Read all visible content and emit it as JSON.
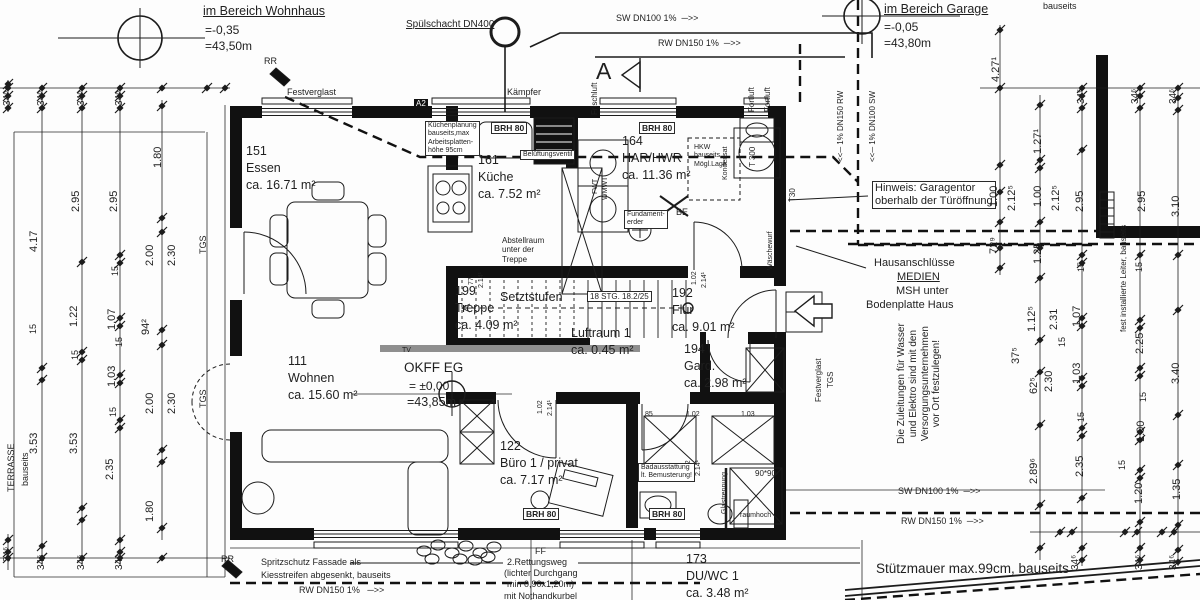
{
  "drawing": {
    "type": "floor-plan",
    "language": "de",
    "level_markers": [
      {
        "area": "im Bereich Wohnhaus",
        "rel": "=-0,35",
        "abs": "=43,50m"
      },
      {
        "area": "im Bereich Garage",
        "rel": "=-0,05",
        "abs": "=43,80m"
      },
      {
        "area": "OKFF EG",
        "rel": "= ±0,00",
        "abs": "=43,85m"
      }
    ],
    "colors": {
      "line": "#1f1f1f",
      "wall": "#111111",
      "bg": "#fdfdfd",
      "tv_band": "#8f8f8f"
    }
  },
  "rooms": [
    {
      "num": "151",
      "name": "Essen",
      "area": "ca. 16.71 m²",
      "x": 246,
      "y": 143
    },
    {
      "num": "161",
      "name": "Küche",
      "area": "ca. 7.52 m²",
      "x": 478,
      "y": 152
    },
    {
      "num": "164",
      "name": "HAR/HWR",
      "area": "ca. 11.36 m²",
      "x": 622,
      "y": 133
    },
    {
      "num": "199",
      "name": "Treppe",
      "area": "ca. 4.09 m²",
      "x": 455,
      "y": 283
    },
    {
      "num": "192",
      "name": "Flur",
      "area": "ca. 9.01 m²",
      "x": 672,
      "y": 285
    },
    {
      "num": "194",
      "name": "Gard.",
      "area": "ca. 2.98 m²",
      "x": 684,
      "y": 341
    },
    {
      "num": "111",
      "name": "Wohnen",
      "area": "ca. 15.60 m²",
      "x": 288,
      "y": 353
    },
    {
      "num": "122",
      "name": "Büro 1 / privat",
      "area": "ca. 7.17 m²",
      "x": 500,
      "y": 438
    },
    {
      "num": "173",
      "name": "DU/WC 1",
      "area": "ca. 3.48 m²",
      "x": 686,
      "y": 551
    }
  ],
  "texts": [
    {
      "t": "im Bereich Wohnhaus",
      "x": 203,
      "y": 4,
      "fs": 12.5,
      "u": 1
    },
    {
      "t": "=-0,35",
      "x": 205,
      "y": 23,
      "fs": 12
    },
    {
      "t": "=43,50m",
      "x": 205,
      "y": 39,
      "fs": 12
    },
    {
      "t": "Spülschacht DN400",
      "x": 406,
      "y": 19,
      "fs": 10,
      "u": 1
    },
    {
      "t": "SW DN100 1%  ─>>",
      "x": 616,
      "y": 13,
      "fs": 9
    },
    {
      "t": "RW DN150 1%  ─>>",
      "x": 658,
      "y": 38,
      "fs": 9
    },
    {
      "t": "im Bereich Garage",
      "x": 884,
      "y": 2,
      "fs": 12.5,
      "u": 1
    },
    {
      "t": "=-0,05",
      "x": 884,
      "y": 20,
      "fs": 12
    },
    {
      "t": "=43,80m",
      "x": 884,
      "y": 36,
      "fs": 12
    },
    {
      "t": "bauseits",
      "x": 1043,
      "y": 1,
      "fs": 9
    },
    {
      "t": "A",
      "x": 596,
      "y": 58,
      "fs": 23
    },
    {
      "t": "Frischluft",
      "x": 590,
      "y": 115,
      "rot": 1,
      "fs": 8
    },
    {
      "t": "Fortluft",
      "x": 747,
      "y": 112,
      "rot": 1,
      "fs": 8
    },
    {
      "t": "Fortluft",
      "x": 763,
      "y": 112,
      "rot": 1,
      "fs": 8
    },
    {
      "t": "<<─ 1% DN150 RW",
      "x": 836,
      "y": 162,
      "rot": 1,
      "fs": 8
    },
    {
      "t": "<<─ 1% DN100 SW",
      "x": 868,
      "y": 162,
      "rot": 1,
      "fs": 8
    },
    {
      "t": "RR",
      "x": 264,
      "y": 56,
      "fs": 9
    },
    {
      "t": "Festverglast",
      "x": 287,
      "y": 87,
      "fs": 9
    },
    {
      "t": "Kämpfer",
      "x": 507,
      "y": 87,
      "fs": 9
    },
    {
      "t": "A2",
      "x": 414,
      "y": 99,
      "fs": 8,
      "inv": 1
    },
    {
      "t": "Küchenplanung\nbauseits,max\nArbeitsplatten-\nhöhe 95cm",
      "x": 425,
      "y": 121,
      "fs": 7,
      "box": 1
    },
    {
      "t": "BRH 80",
      "x": 491,
      "y": 122,
      "fs": 8.5,
      "b": 1,
      "box": 1
    },
    {
      "t": "BRH 80",
      "x": 639,
      "y": 122,
      "fs": 8.5,
      "b": 1,
      "box": 1
    },
    {
      "t": "Belüftungsventil",
      "x": 520,
      "y": 150,
      "fs": 7,
      "box": 1
    },
    {
      "t": "HKW\nbauseits\nMögl.Lage",
      "x": 694,
      "y": 144,
      "fs": 7
    },
    {
      "t": "Kondensat",
      "x": 722,
      "y": 180,
      "rot": 1,
      "fs": 7
    },
    {
      "t": "T 300",
      "x": 748,
      "y": 167,
      "rot": 1,
      "fs": 8
    },
    {
      "t": "T30",
      "x": 788,
      "y": 202,
      "rot": 1,
      "fs": 8
    },
    {
      "t": "FWT",
      "x": 592,
      "y": 194,
      "rot": 1,
      "fs": 7
    },
    {
      "t": "WMWT",
      "x": 602,
      "y": 200,
      "rot": 1,
      "fs": 7
    },
    {
      "t": "Fundament-\nerder",
      "x": 624,
      "y": 210,
      "fs": 7,
      "box": 1
    },
    {
      "t": "BE",
      "x": 676,
      "y": 207,
      "fs": 9
    },
    {
      "t": "Wäschewurf",
      "x": 767,
      "y": 270,
      "rot": 1,
      "fs": 7
    },
    {
      "t": "Abstellraum\nunter der\nTreppe",
      "x": 502,
      "y": 236,
      "fs": 8
    },
    {
      "t": "Setztstufen",
      "x": 500,
      "y": 290,
      "fs": 12.5
    },
    {
      "t": "18 STG. 18.2/25",
      "x": 587,
      "y": 291,
      "fs": 8,
      "box": 1
    },
    {
      "t": "Luftraum 1",
      "x": 571,
      "y": 326,
      "fs": 12.5
    },
    {
      "t": "ca. 0.45 m²",
      "x": 571,
      "y": 343,
      "fs": 12.5
    },
    {
      "t": "TV",
      "x": 402,
      "y": 347,
      "fs": 7
    },
    {
      "t": "OKFF EG",
      "x": 404,
      "y": 360,
      "fs": 13.5
    },
    {
      "t": "= ±0,00",
      "x": 409,
      "y": 379,
      "fs": 12
    },
    {
      "t": "=43,85m",
      "x": 407,
      "y": 395,
      "fs": 12.5
    },
    {
      "t": "77",
      "x": 468,
      "y": 285,
      "rot": 1,
      "fs": 7
    },
    {
      "t": "2.14¹",
      "x": 478,
      "y": 288,
      "rot": 1,
      "fs": 7
    },
    {
      "t": "1.02",
      "x": 691,
      "y": 285,
      "rot": 1,
      "fs": 7
    },
    {
      "t": "2.14¹",
      "x": 701,
      "y": 288,
      "rot": 1,
      "fs": 7
    },
    {
      "t": "1.02",
      "x": 537,
      "y": 414,
      "rot": 1,
      "fs": 7
    },
    {
      "t": "2.14¹",
      "x": 547,
      "y": 416,
      "rot": 1,
      "fs": 7
    },
    {
      "t": "1.02",
      "x": 685,
      "y": 474,
      "rot": 1,
      "fs": 7
    },
    {
      "t": "2.14¹",
      "x": 695,
      "y": 476,
      "rot": 1,
      "fs": 7
    },
    {
      "t": "85",
      "x": 645,
      "y": 411,
      "fs": 7
    },
    {
      "t": "1.02",
      "x": 686,
      "y": 411,
      "fs": 7
    },
    {
      "t": "1.03",
      "x": 741,
      "y": 411,
      "fs": 7
    },
    {
      "t": "BRH 80",
      "x": 523,
      "y": 508,
      "fs": 8.5,
      "b": 1,
      "box": 1
    },
    {
      "t": "BRH 80",
      "x": 649,
      "y": 508,
      "fs": 8.5,
      "b": 1,
      "box": 1
    },
    {
      "t": "Badausstattung\nlt. Bemusterung!",
      "x": 638,
      "y": 463,
      "fs": 7,
      "box": 1
    },
    {
      "t": "Glastrennung",
      "x": 721,
      "y": 514,
      "rot": 1,
      "fs": 7
    },
    {
      "t": "90*90",
      "x": 755,
      "y": 469,
      "fs": 8
    },
    {
      "t": "raumhoch",
      "x": 740,
      "y": 512,
      "fs": 7
    },
    {
      "t": "Hinweis: Garagentor\noberhalb der Türöffnung",
      "x": 872,
      "y": 181,
      "fs": 11,
      "box": 1
    },
    {
      "t": "Hausanschlüsse",
      "x": 874,
      "y": 257,
      "fs": 11
    },
    {
      "t": "MEDIEN",
      "x": 897,
      "y": 271,
      "fs": 11,
      "u": 1
    },
    {
      "t": "MSH unter",
      "x": 896,
      "y": 285,
      "fs": 11
    },
    {
      "t": "Bodenplatte Haus",
      "x": 866,
      "y": 299,
      "fs": 11
    },
    {
      "t": "Die Zuleitungen für Wasser\nund Elektro sind mit den\nVersorgungsunternehmen\nvor Ort festzulegen!",
      "x": 896,
      "y": 444,
      "rot": 1,
      "fs": 10,
      "ta": "center"
    },
    {
      "t": "Festverglast",
      "x": 814,
      "y": 402,
      "rot": 1,
      "fs": 8
    },
    {
      "t": "TGS",
      "x": 826,
      "y": 388,
      "rot": 1,
      "fs": 8
    },
    {
      "t": "TGS",
      "x": 198,
      "y": 254,
      "rot": 1,
      "fs": 9
    },
    {
      "t": "TGS",
      "x": 198,
      "y": 408,
      "rot": 1,
      "fs": 9
    },
    {
      "t": "TERRASSE",
      "x": 6,
      "y": 492,
      "rot": 1,
      "fs": 9
    },
    {
      "t": "bauseits",
      "x": 20,
      "y": 486,
      "rot": 1,
      "fs": 9
    },
    {
      "t": "fest installierte Leiter, bauseits",
      "x": 1119,
      "y": 332,
      "rot": 1,
      "fs": 8
    },
    {
      "t": "SW DN100 1%  ─>>",
      "x": 898,
      "y": 486,
      "fs": 9
    },
    {
      "t": "RW DN150 1%  ─>>",
      "x": 901,
      "y": 516,
      "fs": 9
    },
    {
      "t": "Stützmauer max.99cm, bauseits",
      "x": 876,
      "y": 561,
      "fs": 13.5
    },
    {
      "t": "RR",
      "x": 221,
      "y": 554,
      "fs": 9
    },
    {
      "t": "Spritzschutz Fassade als",
      "x": 261,
      "y": 557,
      "fs": 9
    },
    {
      "t": "Kiesstreifen abgesenkt, bauseits",
      "x": 261,
      "y": 570,
      "fs": 9
    },
    {
      "t": "RW DN150 1%   ─>>",
      "x": 299,
      "y": 585,
      "fs": 9
    },
    {
      "t": "FF",
      "x": 535,
      "y": 546,
      "fs": 9
    },
    {
      "t": "2.Rettungsweg",
      "x": 507,
      "y": 557,
      "fs": 9
    },
    {
      "t": "(lichter Durchgang",
      "x": 504,
      "y": 568,
      "fs": 9
    },
    {
      "t": "min 0,90x1,20m)",
      "x": 507,
      "y": 579,
      "fs": 9
    },
    {
      "t": "mit Nothandkurbel",
      "x": 504,
      "y": 591,
      "fs": 9
    },
    {
      "t": "34⁶",
      "x": 2,
      "y": 106,
      "rot": 1,
      "fs": 10
    },
    {
      "t": "34⁶",
      "x": 36,
      "y": 106,
      "rot": 1,
      "fs": 10
    },
    {
      "t": "34⁶",
      "x": 76,
      "y": 106,
      "rot": 1,
      "fs": 10
    },
    {
      "t": "34⁶",
      "x": 114,
      "y": 106,
      "rot": 1,
      "fs": 10
    },
    {
      "t": "1.80",
      "x": 152,
      "y": 168,
      "rot": 1,
      "fs": 11
    },
    {
      "t": "2.95",
      "x": 70,
      "y": 212,
      "rot": 1,
      "fs": 11
    },
    {
      "t": "2.95",
      "x": 108,
      "y": 212,
      "rot": 1,
      "fs": 11
    },
    {
      "t": "4.17",
      "x": 28,
      "y": 252,
      "rot": 1,
      "fs": 11
    },
    {
      "t": "2.00",
      "x": 144,
      "y": 266,
      "rot": 1,
      "fs": 11
    },
    {
      "t": "2.30",
      "x": 166,
      "y": 266,
      "rot": 1,
      "fs": 11
    },
    {
      "t": "15",
      "x": 110,
      "y": 276,
      "rot": 1,
      "fs": 9
    },
    {
      "t": "1.22",
      "x": 68,
      "y": 327,
      "rot": 1,
      "fs": 11
    },
    {
      "t": "1.07",
      "x": 106,
      "y": 330,
      "rot": 1,
      "fs": 11
    },
    {
      "t": "15",
      "x": 28,
      "y": 334,
      "rot": 1,
      "fs": 9
    },
    {
      "t": "94²",
      "x": 140,
      "y": 335,
      "rot": 1,
      "fs": 11
    },
    {
      "t": "15",
      "x": 70,
      "y": 360,
      "rot": 1,
      "fs": 9
    },
    {
      "t": "15",
      "x": 114,
      "y": 347,
      "rot": 1,
      "fs": 9
    },
    {
      "t": "1.03",
      "x": 106,
      "y": 387,
      "rot": 1,
      "fs": 11
    },
    {
      "t": "2.00",
      "x": 144,
      "y": 414,
      "rot": 1,
      "fs": 11
    },
    {
      "t": "2.30",
      "x": 166,
      "y": 414,
      "rot": 1,
      "fs": 11
    },
    {
      "t": "15",
      "x": 108,
      "y": 417,
      "rot": 1,
      "fs": 9
    },
    {
      "t": "3.53",
      "x": 28,
      "y": 454,
      "rot": 1,
      "fs": 11
    },
    {
      "t": "3.53",
      "x": 68,
      "y": 454,
      "rot": 1,
      "fs": 11
    },
    {
      "t": "2.35",
      "x": 104,
      "y": 480,
      "rot": 1,
      "fs": 11
    },
    {
      "t": "1.80",
      "x": 144,
      "y": 522,
      "rot": 1,
      "fs": 11
    },
    {
      "t": "34⁶",
      "x": 36,
      "y": 570,
      "rot": 1,
      "fs": 10
    },
    {
      "t": "34⁶",
      "x": 76,
      "y": 570,
      "rot": 1,
      "fs": 10
    },
    {
      "t": "34⁶",
      "x": 114,
      "y": 570,
      "rot": 1,
      "fs": 10
    },
    {
      "t": "34⁶",
      "x": 2,
      "y": 562,
      "rot": 1,
      "fs": 10
    },
    {
      "t": "4.27¹",
      "x": 990,
      "y": 82,
      "rot": 1,
      "fs": 11
    },
    {
      "t": "34⁶",
      "x": 1076,
      "y": 104,
      "rot": 1,
      "fs": 10
    },
    {
      "t": "34⁶",
      "x": 1130,
      "y": 104,
      "rot": 1,
      "fs": 10
    },
    {
      "t": "34⁶",
      "x": 1168,
      "y": 104,
      "rot": 1,
      "fs": 10
    },
    {
      "t": "1.27¹",
      "x": 1032,
      "y": 154,
      "rot": 1,
      "fs": 11
    },
    {
      "t": "1.00",
      "x": 988,
      "y": 207,
      "rot": 1,
      "fs": 11
    },
    {
      "t": "2.12⁵",
      "x": 1006,
      "y": 211,
      "rot": 1,
      "fs": 11
    },
    {
      "t": "1.00",
      "x": 1032,
      "y": 207,
      "rot": 1,
      "fs": 11
    },
    {
      "t": "2.12⁵",
      "x": 1050,
      "y": 211,
      "rot": 1,
      "fs": 11
    },
    {
      "t": "2.95",
      "x": 1074,
      "y": 212,
      "rot": 1,
      "fs": 11
    },
    {
      "t": "2.95",
      "x": 1136,
      "y": 212,
      "rot": 1,
      "fs": 11
    },
    {
      "t": "3.10",
      "x": 1170,
      "y": 217,
      "rot": 1,
      "fs": 11
    },
    {
      "t": "72⁹",
      "x": 988,
      "y": 254,
      "rot": 1,
      "fs": 11
    },
    {
      "t": "1.25",
      "x": 1032,
      "y": 264,
      "rot": 1,
      "fs": 11
    },
    {
      "t": "15",
      "x": 1076,
      "y": 272,
      "rot": 1,
      "fs": 9
    },
    {
      "t": "15",
      "x": 1134,
      "y": 272,
      "rot": 1,
      "fs": 9
    },
    {
      "t": "1.12⁵",
      "x": 1026,
      "y": 332,
      "rot": 1,
      "fs": 11
    },
    {
      "t": "2.31",
      "x": 1048,
      "y": 330,
      "rot": 1,
      "fs": 11
    },
    {
      "t": "1.07",
      "x": 1071,
      "y": 327,
      "rot": 1,
      "fs": 11
    },
    {
      "t": "37⁵",
      "x": 1010,
      "y": 364,
      "rot": 1,
      "fs": 11
    },
    {
      "t": "15",
      "x": 1057,
      "y": 347,
      "rot": 1,
      "fs": 9
    },
    {
      "t": "2.25",
      "x": 1134,
      "y": 354,
      "rot": 1,
      "fs": 11
    },
    {
      "t": "62⁵",
      "x": 1028,
      "y": 394,
      "rot": 1,
      "fs": 11
    },
    {
      "t": "2.30",
      "x": 1043,
      "y": 392,
      "rot": 1,
      "fs": 11
    },
    {
      "t": "1.03",
      "x": 1071,
      "y": 384,
      "rot": 1,
      "fs": 11
    },
    {
      "t": "3.40",
      "x": 1170,
      "y": 384,
      "rot": 1,
      "fs": 11
    },
    {
      "t": "15",
      "x": 1076,
      "y": 422,
      "rot": 1,
      "fs": 9
    },
    {
      "t": "15",
      "x": 1138,
      "y": 402,
      "rot": 1,
      "fs": 9
    },
    {
      "t": "1.00",
      "x": 1135,
      "y": 442,
      "rot": 1,
      "fs": 11
    },
    {
      "t": "15",
      "x": 1117,
      "y": 470,
      "rot": 1,
      "fs": 9
    },
    {
      "t": "2.35",
      "x": 1074,
      "y": 477,
      "rot": 1,
      "fs": 11
    },
    {
      "t": "2.89⁶",
      "x": 1028,
      "y": 484,
      "rot": 1,
      "fs": 11
    },
    {
      "t": "1.20",
      "x": 1133,
      "y": 504,
      "rot": 1,
      "fs": 11
    },
    {
      "t": "1.35",
      "x": 1171,
      "y": 500,
      "rot": 1,
      "fs": 11
    },
    {
      "t": "34⁶",
      "x": 1070,
      "y": 570,
      "rot": 1,
      "fs": 10
    },
    {
      "t": "34⁶",
      "x": 1134,
      "y": 570,
      "rot": 1,
      "fs": 10
    },
    {
      "t": "34⁶",
      "x": 1168,
      "y": 570,
      "rot": 1,
      "fs": 10
    }
  ],
  "chains": {
    "v": [
      {
        "x": 42,
        "y1": 88,
        "y2": 566,
        "t": [
          96,
          108,
          368,
          380,
          546,
          558
        ]
      },
      {
        "x": 82,
        "y1": 88,
        "y2": 566,
        "t": [
          96,
          108,
          262,
          352,
          360,
          508,
          520
        ]
      },
      {
        "x": 120,
        "y1": 88,
        "y2": 566,
        "t": [
          96,
          108,
          255,
          263,
          318,
          326,
          375,
          383,
          420,
          428,
          540,
          552
        ]
      },
      {
        "x": 162,
        "y1": 100,
        "y2": 540,
        "t": [
          106,
          218,
          232,
          330,
          345,
          450,
          462,
          528
        ]
      },
      {
        "x": 8,
        "y1": 80,
        "y2": 112,
        "t": [
          84,
          96,
          108
        ]
      },
      {
        "x": 8,
        "y1": 534,
        "y2": 570,
        "t": [
          540,
          552
        ]
      },
      {
        "x": 1000,
        "y1": 25,
        "y2": 275,
        "t": [
          30,
          165,
          192,
          222,
          248,
          268
        ]
      },
      {
        "x": 1040,
        "y1": 95,
        "y2": 560,
        "t": [
          105,
          160,
          168,
          222,
          248,
          278,
          340,
          372,
          425,
          505,
          548
        ]
      },
      {
        "x": 1082,
        "y1": 88,
        "y2": 566,
        "t": [
          96,
          108,
          150,
          255,
          263,
          318,
          326,
          378,
          386,
          428,
          436,
          498,
          548,
          560
        ]
      },
      {
        "x": 1140,
        "y1": 88,
        "y2": 566,
        "t": [
          96,
          108,
          255,
          320,
          328,
          368,
          376,
          432,
          440,
          470,
          478,
          522,
          548,
          560
        ]
      },
      {
        "x": 1178,
        "y1": 88,
        "y2": 566,
        "t": [
          98,
          110,
          255,
          310,
          415,
          465,
          525,
          550,
          562
        ]
      }
    ],
    "h": [
      {
        "y": 88,
        "x1": 0,
        "x2": 230,
        "t": [
          8,
          42,
          82,
          120,
          162,
          207,
          225
        ]
      },
      {
        "y": 88,
        "x1": 980,
        "x2": 1200,
        "t": [
          1000,
          1082,
          1140,
          1178
        ]
      },
      {
        "y": 532,
        "x1": 1030,
        "x2": 1200,
        "t": [
          1060,
          1072,
          1125,
          1137,
          1162,
          1174
        ]
      },
      {
        "y": 558,
        "x1": 0,
        "x2": 230,
        "t": [
          8,
          42,
          82,
          120,
          162
        ]
      }
    ]
  }
}
